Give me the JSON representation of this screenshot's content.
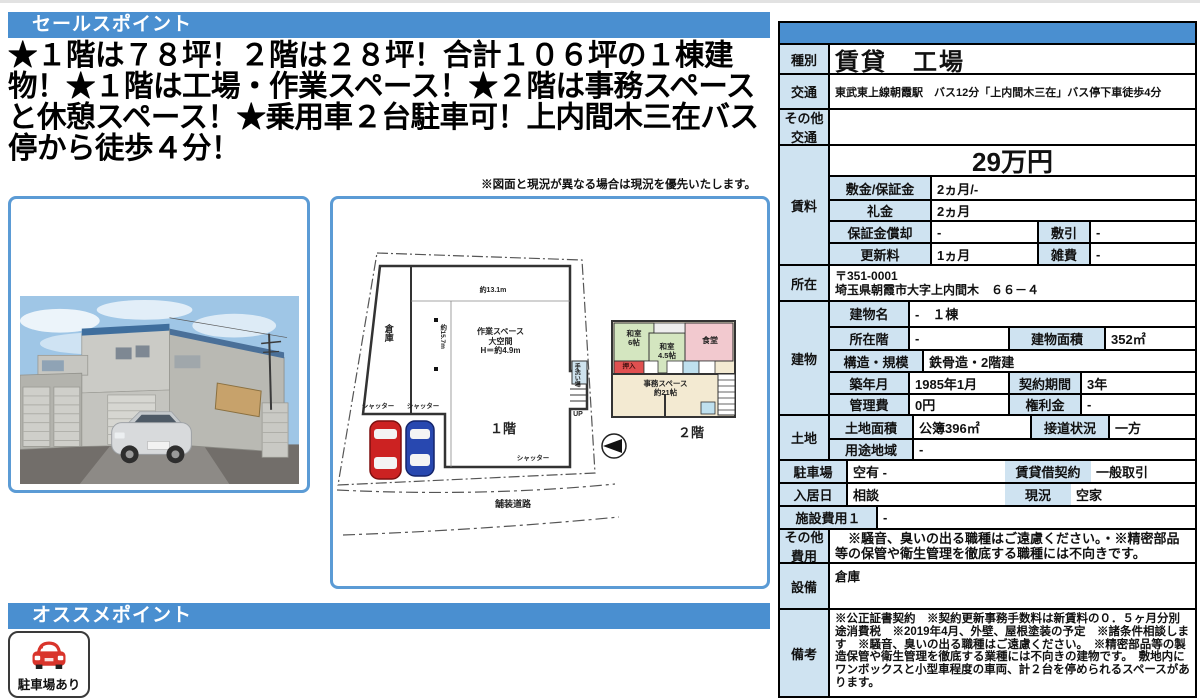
{
  "colors": {
    "header_blue": "#4a8fd0",
    "label_blue": "#cfe3f1",
    "frame_blue": "#5b9bd5",
    "car_red": "#d9342b",
    "car_blue": "#2848b0"
  },
  "sales": {
    "header": "セールスポイント",
    "body": "★１階は７８坪！２階は２８坪！合計１０６坪の１棟建物！★１階は工場・作業スペース！★２階は事務スペースと休憩スペース！★乗用車２台駐車可！上内間木三在バス停から徒歩４分！",
    "note": "※図面と現況が異なる場合は現況を優先いたします。"
  },
  "recommend": {
    "header": "オススメポイント",
    "badge_label": "駐車場あり",
    "badge_icon": "car-icon"
  },
  "floorplan": {
    "dim_top": "約13.1m",
    "dim_left": "約15.7m",
    "souko": "倉庫",
    "workspace": "作業スペース\n大空間\nH＝約4.9m",
    "shutter1": "シャッター",
    "shutter2": "シャッター",
    "shutter3": "シャッター",
    "up": "UP",
    "wash": "手洗い場",
    "f1_caption": "１階",
    "f2_caption": "２階",
    "road": "舗装道路",
    "washitsu6": "和室\n6帖",
    "washitsu45": "和室\n4.5帖",
    "dining": "食堂",
    "oshiire": "押入",
    "office": "事務スペース\n約21帖",
    "compass_icon": "compass-icon"
  },
  "table": {
    "shubetsu": {
      "label": "種別",
      "value": "賃貸　工場"
    },
    "kotsu": {
      "label": "交通",
      "value": "東武東上線朝霞駅　バス12分「上内間木三在」バス停下車徒歩4分"
    },
    "sonota_kotsu": {
      "label": "その他\n交通",
      "value": ""
    },
    "chinryo": {
      "label": "賃料",
      "rent": "29万円",
      "shikikin": {
        "label": "敷金/保証金",
        "value": "2ヵ月/-"
      },
      "reikin": {
        "label": "礼金",
        "value": "2ヵ月"
      },
      "shokyaku": {
        "label": "保証金償却",
        "value": "-"
      },
      "shikibiki": {
        "label": "敷引",
        "value": "-"
      },
      "koshinryo": {
        "label": "更新料",
        "value": "1ヵ月"
      },
      "zappi": {
        "label": "雑費",
        "value": "-"
      }
    },
    "shozai": {
      "label": "所在",
      "value": "〒351-0001\n埼玉県朝霞市大字上内間木　６６－４"
    },
    "tatemono": {
      "label": "建物",
      "name": {
        "label": "建物名",
        "value": "-　１棟"
      },
      "floor": {
        "label": "所在階",
        "value": "-"
      },
      "area": {
        "label": "建物面積",
        "value": "352㎡"
      },
      "kozo": {
        "label": "構造・規模",
        "value": "鉄骨造・2階建"
      },
      "chikunen": {
        "label": "築年月",
        "value": "1985年1月"
      },
      "keiyaku": {
        "label": "契約期間",
        "value": "3年"
      },
      "kanrihi": {
        "label": "管理費",
        "value": "0円"
      },
      "kenrikin": {
        "label": "権利金",
        "value": "-"
      }
    },
    "tochi": {
      "label": "土地",
      "menseki": {
        "label": "土地面積",
        "value": "公簿396㎡"
      },
      "setsudo": {
        "label": "接道状況",
        "value": "一方"
      },
      "yoto": {
        "label": "用途地域",
        "value": "-"
      }
    },
    "chushajo": {
      "label": "駐車場",
      "value": "空有 -"
    },
    "chintaishaku": {
      "label": "賃貸借契約",
      "value": "一般取引"
    },
    "nyukyobi": {
      "label": "入居日",
      "value": "相談"
    },
    "genkyo": {
      "label": "現況",
      "value": "空家"
    },
    "shisetsu": {
      "label": "施設費用１",
      "value": "-"
    },
    "sonota_hiyo": {
      "label": "その他\n費用",
      "value": "　※騒音、臭いの出る職種はご遠慮ください。・※精密部品等の保管や衛生管理を徹底する職種には不向きです。"
    },
    "setsubi": {
      "label": "設備",
      "value": "倉庫"
    },
    "biko": {
      "label": "備考",
      "value": "※公正証書契約　※契約更新事務手数料は新賃料の０．５ヶ月分別途消費税　※2019年4月、外壁、屋根塗装の予定　※諸条件相談します　※騒音、臭いの出る職種はご遠慮ください。　※精密部品等の製造保管や衛生管理を徹底する業種には不向きの建物です。　敷地内にワンボックスと小型車程度の車両、計２台を停められるスペースがあります。"
    }
  }
}
